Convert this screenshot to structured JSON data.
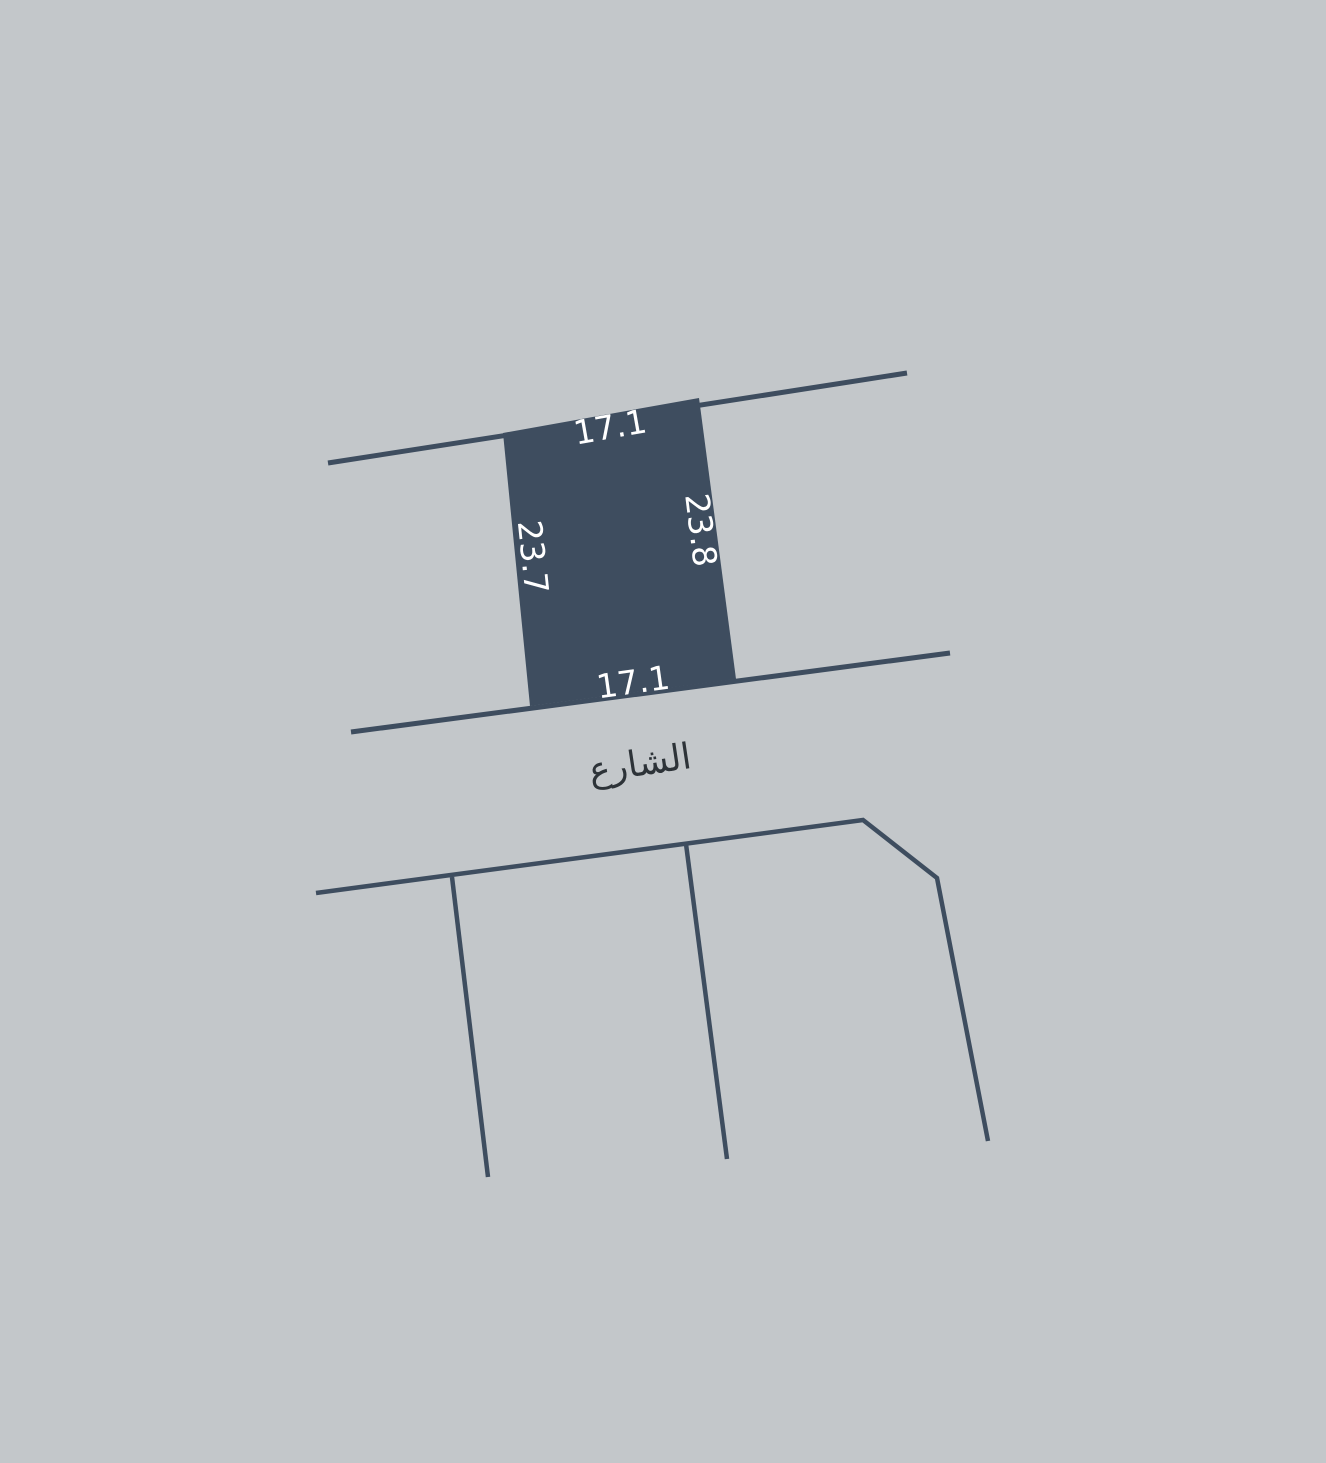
{
  "colors": {
    "background": "#c3c7ca",
    "line": "#3e4d5f",
    "plot_fill": "#3e4d5f",
    "dimension_text": "#ffffff",
    "street_text": "#2d3338"
  },
  "plot": {
    "top_side_length": "17.1",
    "right_side_length": "23.8",
    "left_side_length": "23.7",
    "bottom_side_length": "17.1"
  },
  "street": {
    "name": "الشارع"
  }
}
